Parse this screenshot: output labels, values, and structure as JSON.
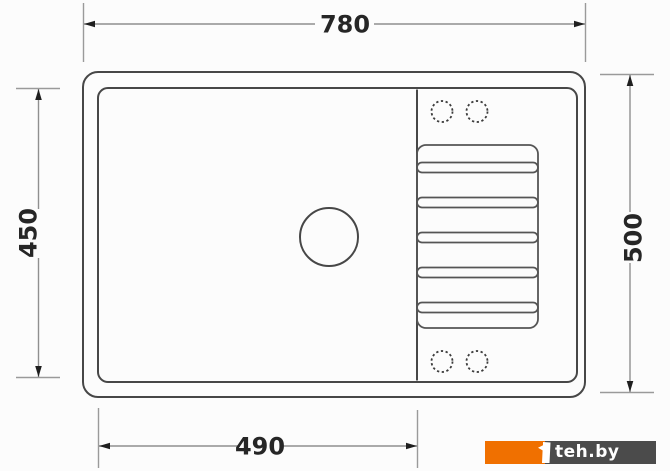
{
  "page": {
    "background_color": "#fcfcfc"
  },
  "drawing": {
    "subject": "kitchen sink top-view technical drawing",
    "labels": {
      "top_width": "780",
      "left_height": "450",
      "right_height": "500",
      "bottom_width": "490"
    },
    "features": {
      "drain_hole": "solid circle in basin",
      "faucet_holes_top": 2,
      "faucet_holes_bottom": 2,
      "drainboard_grooves": 5
    },
    "colors": {
      "outline": "#474747",
      "dimension_line": "#8f8f8f",
      "label": "#262626"
    }
  },
  "watermark": {
    "text": "teh.by",
    "accent_orange": "#f07000",
    "bar_gray": "#4b4b4b",
    "text_color": "#ffffff"
  }
}
